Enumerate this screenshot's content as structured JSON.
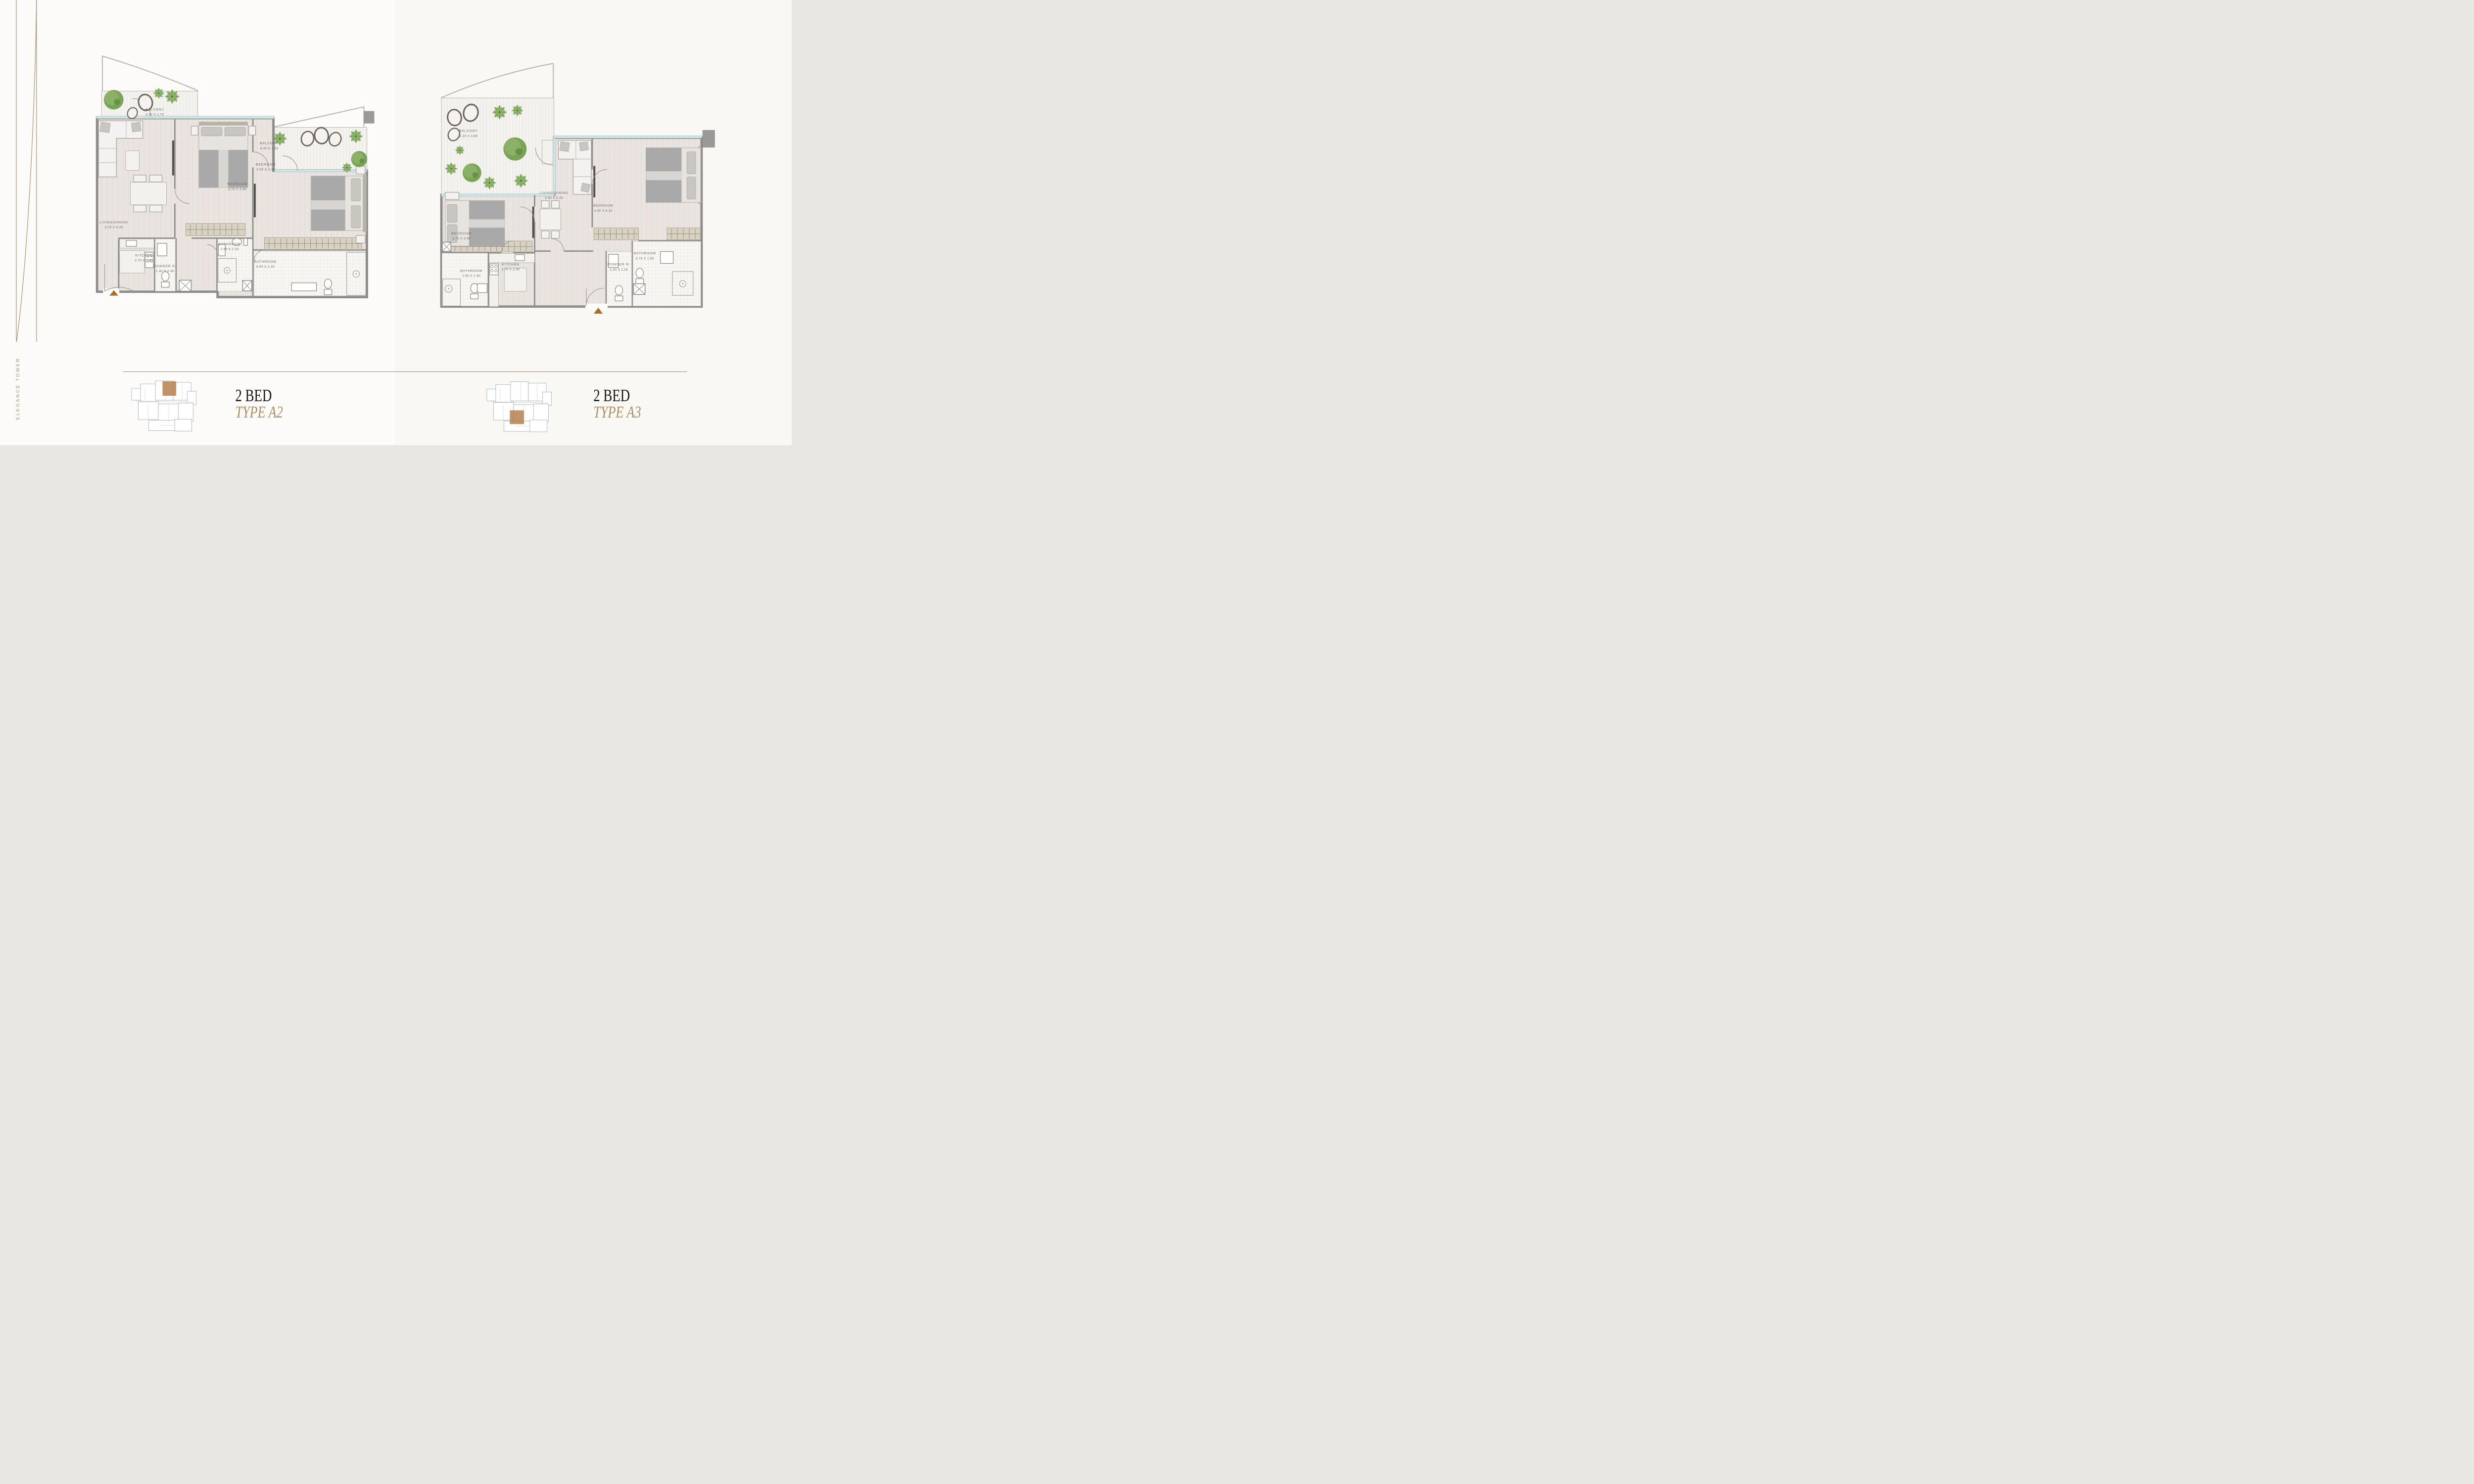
{
  "brand": {
    "vertical_text": "ELEGANCE TOWER"
  },
  "colors": {
    "accent_gold": "#a89272",
    "title_gold": "#ab8e63",
    "title_black": "#181614",
    "wall_gray": "#8e8c8a",
    "glazing_blue": "#cfe4e6",
    "keyplan_highlight": "#b5804f",
    "entry_marker": "#a5712d"
  },
  "plans": [
    {
      "id": "a2",
      "title": "2 BED",
      "subtitle": "TYPE A2",
      "rooms": {
        "balcony1": {
          "name": "BALCONY",
          "dims": "4.00 X 1.70"
        },
        "balcony2": {
          "name": "BALCONY",
          "dims": "4.40 X 1.50"
        },
        "bedroom_mid": {
          "name": "BEDROOM",
          "dims": "3.70 X 3.90"
        },
        "bedroom_right": {
          "name": "BEDROOM",
          "dims": "4.50 X 4.40"
        },
        "living": {
          "name": "LIVING/DINING",
          "dims": "3.70 X 5.20"
        },
        "kitchen": {
          "name": "KITCHEN",
          "dims": "2.70 X 2.50"
        },
        "powder": {
          "name": "POWDER R.",
          "dims": "1.30 X 2.30"
        },
        "bath1": {
          "name": "BATHROOM",
          "dims": "2.50 X 2.30"
        },
        "bath2": {
          "name": "BATHROOM",
          "dims": "4.00 X 2.20"
        }
      }
    },
    {
      "id": "a3",
      "title": "2 BED",
      "subtitle": "TYPE A3",
      "rooms": {
        "balcony": {
          "name": "BALCONY",
          "dims": "5.20 X 3.80"
        },
        "living": {
          "name": "LIVING/DINING",
          "dims": "3.80 X 5.20"
        },
        "bedroom_right": {
          "name": "BEDROOM",
          "dims": "4.30 X 5.20"
        },
        "bedroom_left": {
          "name": "BEDROOM",
          "dims": "3.70 X 3.90"
        },
        "bath_left": {
          "name": "BATHROOM",
          "dims": "2.50 X 2.90"
        },
        "kitchen": {
          "name": "KITCHEN",
          "dims": "2.70 X 2.50"
        },
        "powder": {
          "name": "POWDER R.",
          "dims": "1.30 X 2.30"
        },
        "bath_right": {
          "name": "BATHROOM",
          "dims": "3.70 X 1.50"
        }
      }
    }
  ]
}
